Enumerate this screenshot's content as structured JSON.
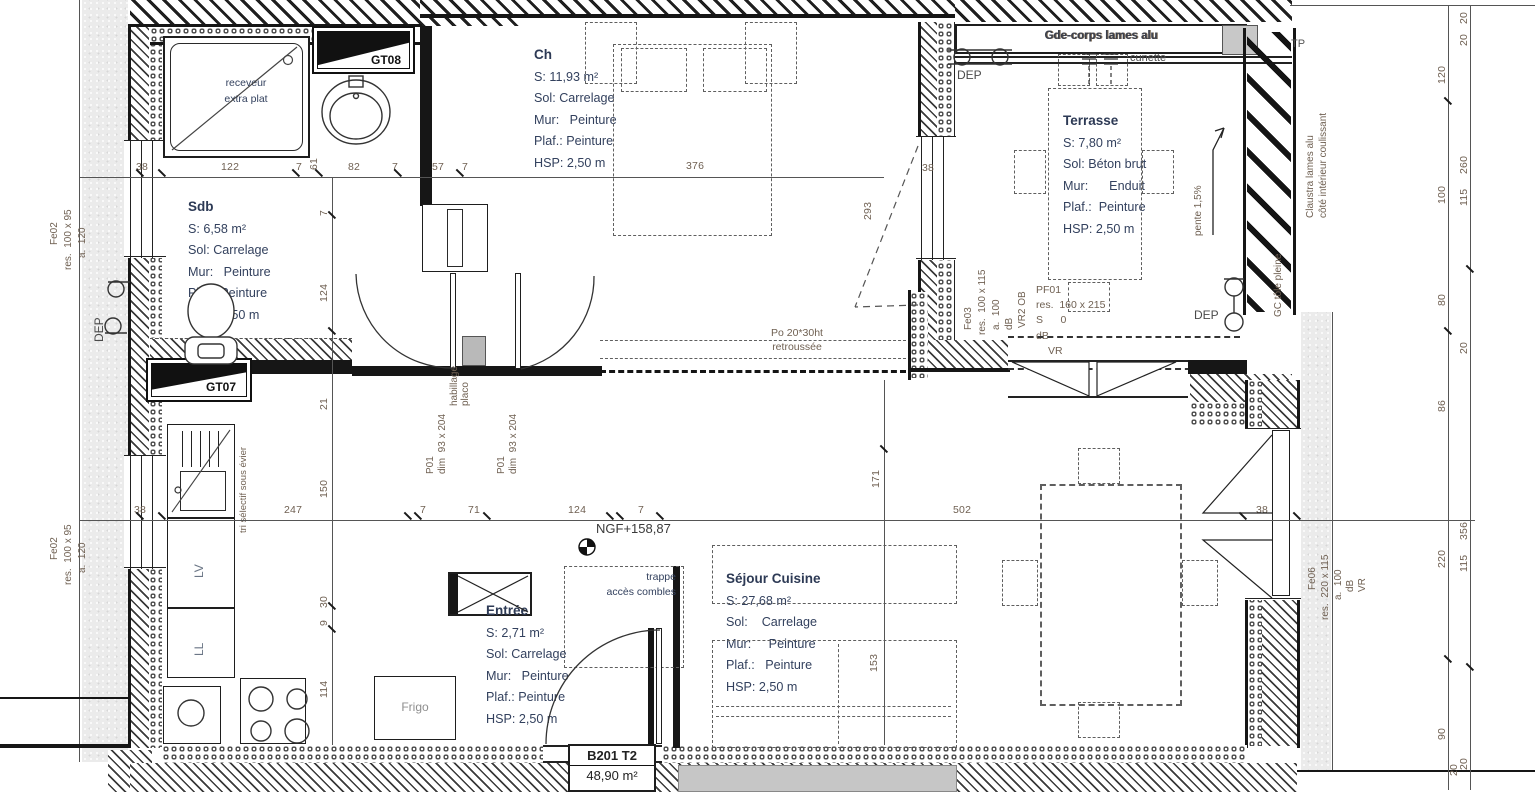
{
  "unit": {
    "ref": "B201 T2",
    "area": "48,90 m²"
  },
  "ngf": "NGF+158,87",
  "rooms": {
    "sdb": {
      "name": "Sdb",
      "l1": "S: 6,58 m²",
      "l2": "Sol: Carrelage",
      "l3": "Mur:   Peinture",
      "l4": "Plaf.: Peinture",
      "l5": "HSP: 2,50 m"
    },
    "ch": {
      "name": "Ch",
      "l1": "S: 11,93 m²",
      "l2": "Sol: Carrelage",
      "l3": "Mur:   Peinture",
      "l4": "Plaf.: Peinture",
      "l5": "HSP: 2,50 m"
    },
    "terrasse": {
      "name": "Terrasse",
      "l1": "S: 7,80 m²",
      "l2": "Sol: Béton brut",
      "l3": "Mur:      Enduit",
      "l4": "Plaf.:  Peinture",
      "l5": "HSP: 2,50 m"
    },
    "sejour": {
      "name": "Séjour Cuisine",
      "l1": "S: 27,68 m²",
      "l2": "Sol:    Carrelage",
      "l3": "Mur:     Peinture",
      "l4": "Plaf.:   Peinture",
      "l5": "HSP: 2,50 m"
    },
    "entree": {
      "name": "Entrée",
      "l1": "S: 2,71 m²",
      "l2": "Sol: Carrelage",
      "l3": "Mur:   Peinture",
      "l4": "Plaf.: Peinture",
      "l5": "HSP: 2,50 m"
    }
  },
  "openings": {
    "fe02a": {
      "ref": "Fe02",
      "res": "res.  100 x 95",
      "a": "a.  120"
    },
    "fe02b": {
      "ref": "Fe02",
      "res": "res.  100 x 95",
      "a": "a.  120"
    },
    "fe03": {
      "ref": "Fe03",
      "res": "res.  100 x 115",
      "a": "a.  100",
      "db": "dB",
      "vr": "VR2 OB"
    },
    "fe06": {
      "ref": "Fe06",
      "res": "res.  220 x 115",
      "a": "a.  100",
      "db": "dB",
      "vr": "VR"
    },
    "pf01": {
      "ref": "PF01",
      "res": "res.  160 x 215",
      "s": "S      0",
      "db": "dB",
      "vr": "VR"
    },
    "p01a": {
      "ref": "P01",
      "dim": "dim  93 x 204"
    },
    "p01b": {
      "ref": "P01",
      "dim": "dim  93 x 204"
    },
    "gt07": "GT07",
    "gt08": "GT08"
  },
  "annotations": {
    "receveur1": "receveur",
    "receveur2": "extra plat",
    "habillage1": "habillage",
    "habillage2": "placo",
    "trappe1": "trappe",
    "trappe2": "accès combles",
    "po1": "Po 20*30ht",
    "po2": "retroussée",
    "cunette": "cunette",
    "dep": "DEP",
    "tri": "tri sélectif sous évier",
    "lv": "LV",
    "ll": "LL",
    "frigo": "Frigo",
    "pente": "pente 1,5%",
    "garde_corps": "Gde-corps lames alu",
    "claustra1": "Claustra lames alu",
    "claustra2": "côté intérieur coulissant",
    "gc": "GC tôle pleine",
    "tp": "TP",
    "vr": "VR"
  },
  "dims": {
    "top": [
      "38",
      "122",
      "7",
      "61",
      "82",
      "7",
      "57",
      "7",
      "376"
    ],
    "mid": [
      "38",
      "247",
      "7",
      "71",
      "124",
      "7",
      "502",
      "38"
    ],
    "left_v": [
      "7",
      "124",
      "21",
      "150",
      "30",
      "9",
      "114"
    ],
    "ch_v": [
      "293",
      "171",
      "153"
    ],
    "ch_w": "38",
    "right_inner": [
      "120",
      "100",
      "80",
      "86",
      "220",
      "90"
    ],
    "right_outer": [
      "20",
      "20",
      "260",
      "115",
      "20",
      "356",
      "115",
      "20"
    ],
    "corner_br": "20"
  }
}
